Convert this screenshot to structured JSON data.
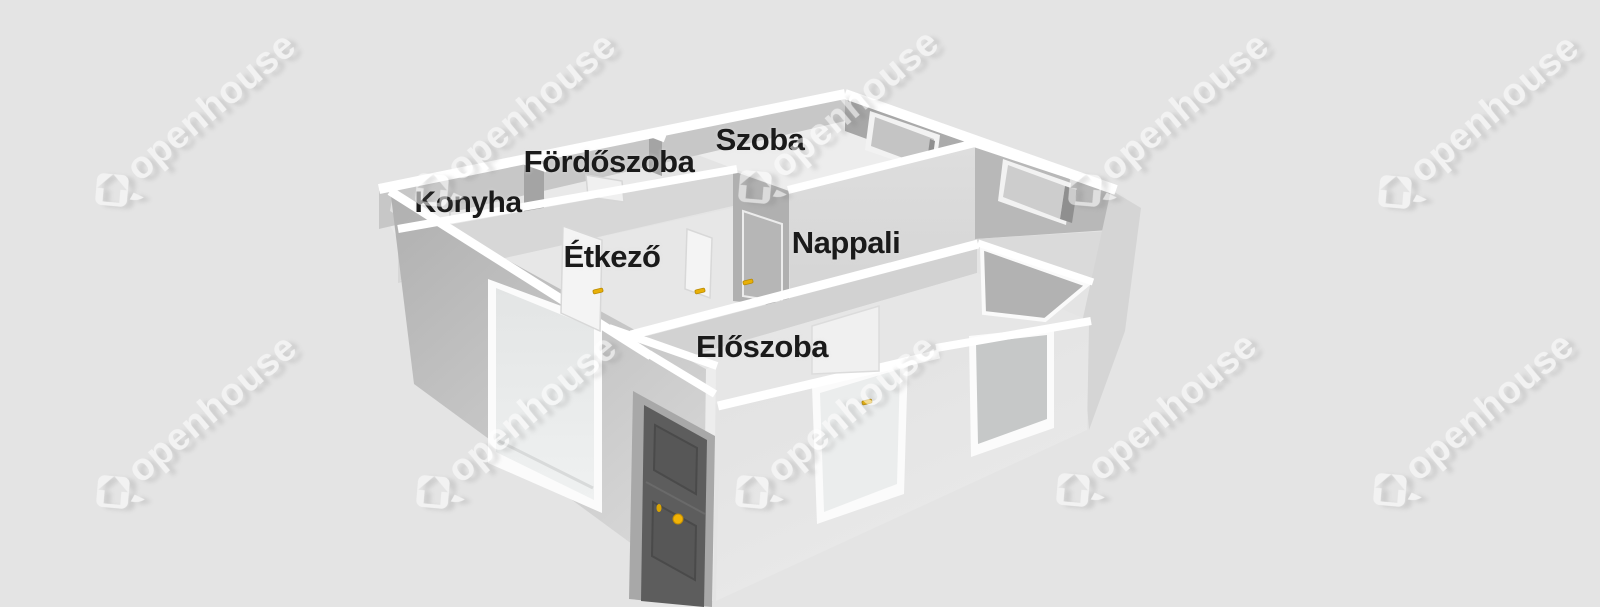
{
  "scene": {
    "type": "3d-floorplan-render",
    "background_color": "#e4e4e4",
    "label_color": "#1a1a1a"
  },
  "rooms": [
    {
      "label": "Konyha",
      "x": 468,
      "y": 203,
      "size": 30
    },
    {
      "label": "Fördőszoba",
      "x": 609,
      "y": 162,
      "size": 31
    },
    {
      "label": "Szoba",
      "x": 760,
      "y": 140,
      "size": 31
    },
    {
      "label": "Étkező",
      "x": 612,
      "y": 257,
      "size": 31
    },
    {
      "label": "Nappali",
      "x": 846,
      "y": 243,
      "size": 31
    },
    {
      "label": "Előszoba",
      "x": 762,
      "y": 347,
      "size": 31
    }
  ],
  "watermark": {
    "text": "openhouse",
    "color": "#ffffff",
    "opacity": 0.55,
    "angle_deg": -40,
    "positions": [
      [
        112,
        190
      ],
      [
        432,
        190
      ],
      [
        755,
        187
      ],
      [
        1085,
        190
      ],
      [
        1395,
        192
      ],
      [
        113,
        492
      ],
      [
        433,
        492
      ],
      [
        752,
        492
      ],
      [
        1073,
        490
      ],
      [
        1390,
        490
      ]
    ]
  },
  "door_hardware": {
    "handle_color": "#e8b007",
    "knob_color": "#f1b306",
    "handles": [
      [
        598,
        291
      ],
      [
        700,
        291
      ],
      [
        748,
        282
      ],
      [
        867,
        402
      ]
    ],
    "entrance_knob": [
      678,
      519
    ],
    "entrance_keyhole": [
      659,
      508
    ]
  },
  "palette": {
    "wall_top": "#ffffff",
    "entrance_door": "#5d5d5d",
    "shaded_wall": "#a4a4a4",
    "lit_wall": "#d7d7d7",
    "floor": "#e9e9e9"
  }
}
